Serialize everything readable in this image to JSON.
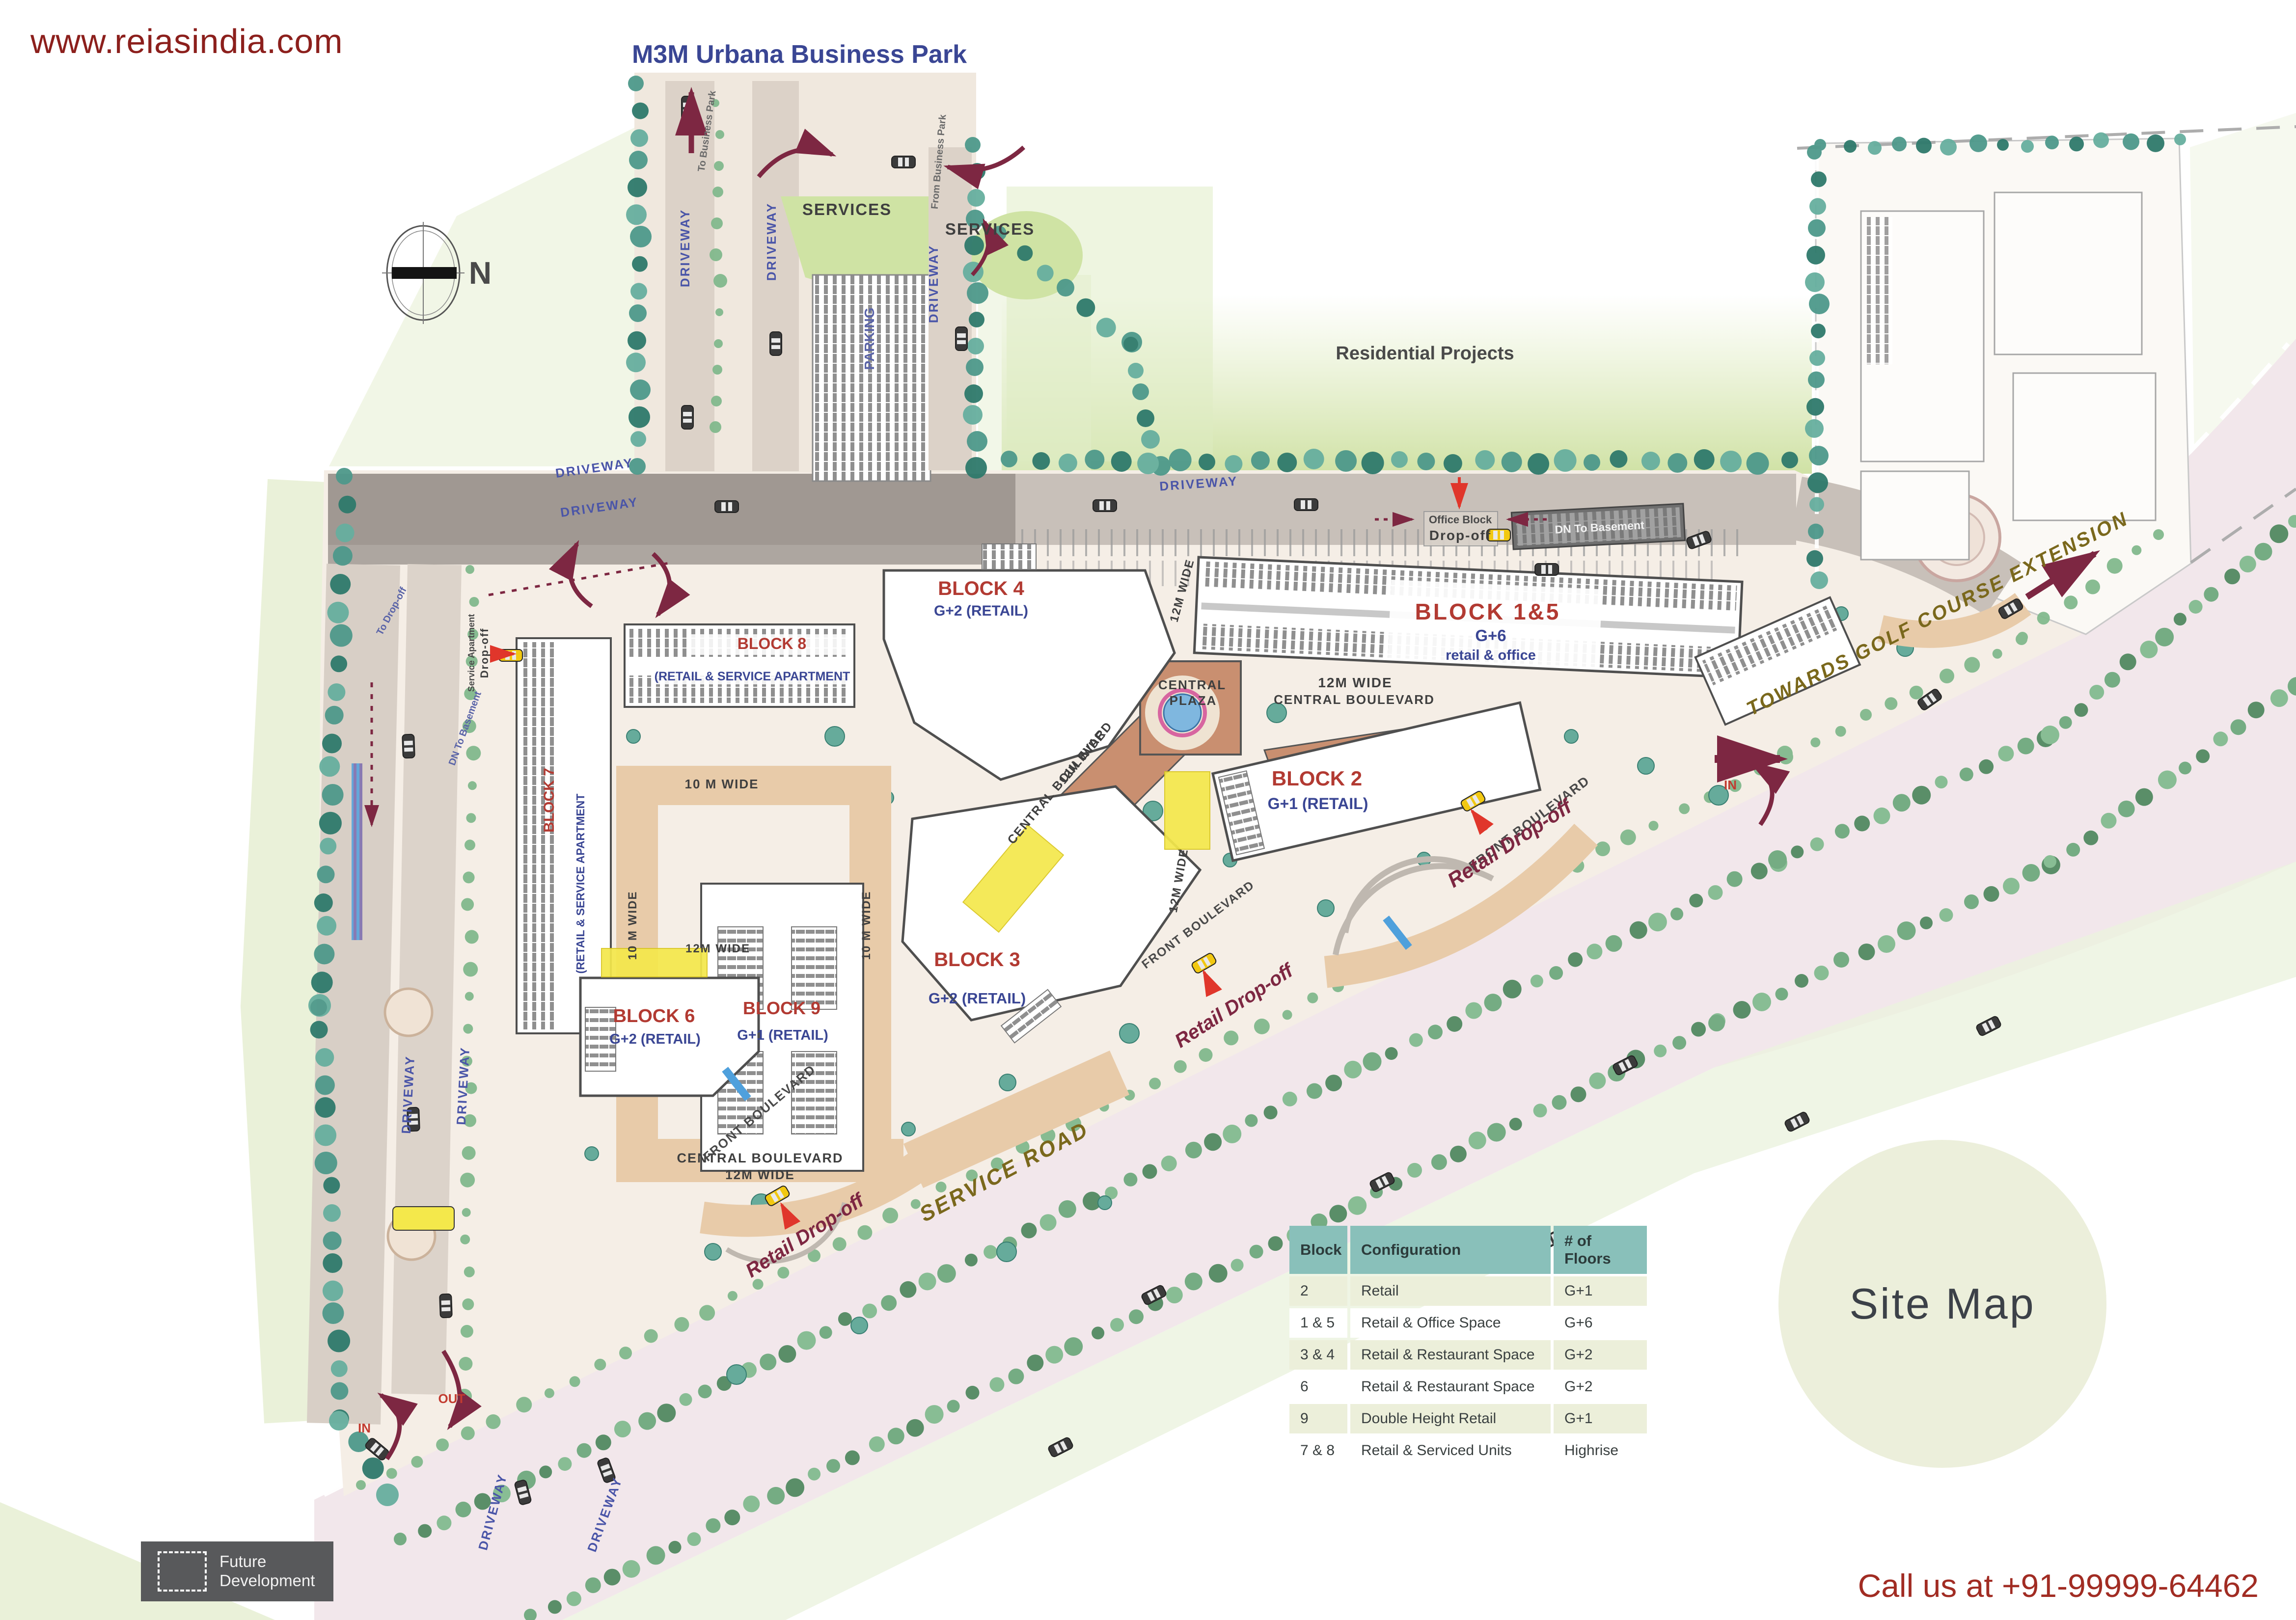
{
  "header": {
    "website": "www.reiasindia.com"
  },
  "map": {
    "title": "M3M Urbana Business Park",
    "compass_n": "N",
    "residential": "Residential Projects",
    "labels": {
      "driveway": "DRIVEWAY",
      "services": "SERVICES",
      "parking": "PARKING",
      "central_plaza_line1": "CENTRAL",
      "central_plaza_line2": "PLAZA",
      "twelve_m_wide": "12M WIDE",
      "central_boulevard": "CENTRAL BOULEVARD",
      "ten_m_wide": "10 M WIDE",
      "front_boulevard": "FRONT BOULEVARD",
      "retail_drop_off": "Retail Drop-off",
      "service_road": "SERVICE ROAD",
      "towards_golf": "TOWARDS GOLF COURSE EXTENSION",
      "in": "IN",
      "out": "OUT",
      "office_block": "Office Block",
      "drop_off": "Drop-off",
      "dn_to_basement": "DN To Basement",
      "to_business_park": "To Business Park",
      "from_business_park": "From Business Park",
      "to_drop_off": "To Drop-off",
      "service_apartment": "Service Apartment"
    },
    "blocks": [
      {
        "name": "BLOCK 1&5",
        "floors": "G+6",
        "use": "retail & office"
      },
      {
        "name": "BLOCK 4",
        "floors": "G+2 (RETAIL)"
      },
      {
        "name": "BLOCK 8",
        "use": "(RETAIL & SERVICE APARTMENT"
      },
      {
        "name": "BLOCK 7",
        "use": "(RETAIL & SERVICE APARTMENT"
      },
      {
        "name": "BLOCK 9",
        "floors": "G+1 (RETAIL)"
      },
      {
        "name": "BLOCK 2",
        "floors": "G+1 (RETAIL)"
      },
      {
        "name": "BLOCK 3",
        "floors": "G+2 (RETAIL)"
      },
      {
        "name": "BLOCK 6",
        "floors": "G+2 (RETAIL)"
      }
    ]
  },
  "table": {
    "headers": [
      "Block",
      "Configuration",
      "# of Floors"
    ],
    "rows": [
      [
        "2",
        "Retail",
        "G+1"
      ],
      [
        "1 & 5",
        "Retail & Office Space",
        "G+6"
      ],
      [
        "3 & 4",
        "Retail & Restaurant Space",
        "G+2"
      ],
      [
        "6",
        "Retail & Restaurant Space",
        "G+2"
      ],
      [
        "9",
        "Double Height Retail",
        "G+1"
      ],
      [
        "7 & 8",
        "Retail & Serviced Units",
        "Highrise"
      ]
    ]
  },
  "badge": {
    "site_map": "Site Map"
  },
  "legend": {
    "line1": "Future",
    "line2": "Development"
  },
  "footer": {
    "phone": "Call us at +91-99999-64462"
  },
  "colors": {
    "block_label_red": "#B23A32",
    "sub_label_navy": "#3A4694",
    "table_header_teal": "#89C0BA",
    "table_row_beige": "#ECEFDA",
    "site_map_circle": "#ECEFDB",
    "legend_gray": "#58595B",
    "url_red": "#8C1F1C",
    "phone_red": "#A12C23",
    "arrow_maroon": "#7D2742"
  }
}
